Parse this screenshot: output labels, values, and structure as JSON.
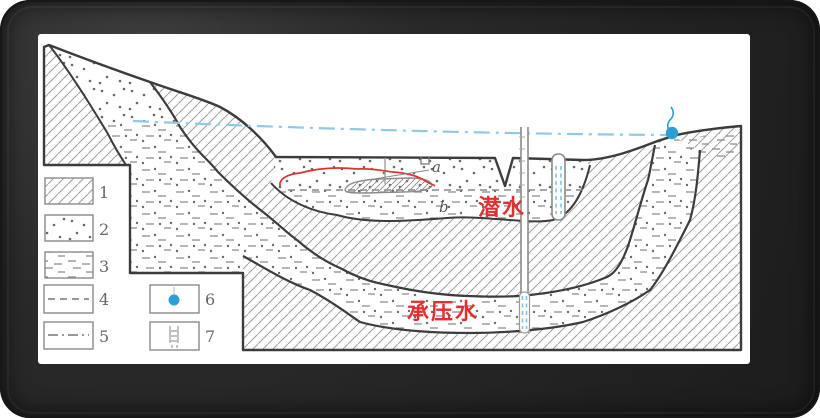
{
  "figure": {
    "type": "hydrogeology-cross-section",
    "annotations": {
      "label_a": "a",
      "label_b": "b",
      "phreatic_water": "潜水",
      "confined_water": "承压水"
    },
    "legend": {
      "items": [
        {
          "number": "1",
          "symbol": "diagonal-hatch-impermeable-rock"
        },
        {
          "number": "2",
          "symbol": "dots-sand-aquifer"
        },
        {
          "number": "3",
          "symbol": "short-dashes-silt"
        },
        {
          "number": "4",
          "symbol": "dashed-line-water-table"
        },
        {
          "number": "5",
          "symbol": "dash-dot-line-piezometric-level"
        },
        {
          "number": "6",
          "symbol": "spring"
        },
        {
          "number": "7",
          "symbol": "screened-well"
        }
      ]
    },
    "colors": {
      "annotation_red": "#e03030",
      "water_blue": "#2b9fd6",
      "piezometric_blue": "#8ec9e6",
      "line_dark": "#3c3c3c",
      "pattern_gray": "#9a9a9a"
    }
  }
}
